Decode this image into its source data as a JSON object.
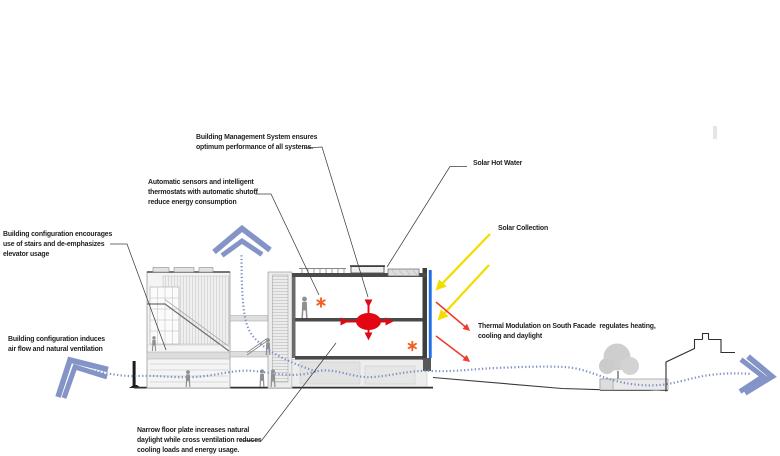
{
  "diagram_title": "Sustainable building systems section diagram",
  "annotations": {
    "bms": {
      "lines": [
        "Building Management System ensures",
        "optimum performance of all systems."
      ]
    },
    "sensors": {
      "lines": [
        "Automatic sensors and intelligent",
        "thermostats with automatic shutoff",
        "reduce energy consumption"
      ]
    },
    "stairs": {
      "lines": [
        "Building configuration encourages",
        "use of stairs and de-emphasizes",
        "elevator usage"
      ]
    },
    "airflow": {
      "lines": [
        "Building configuration induces",
        "air flow and natural ventilation"
      ]
    },
    "solar_hot_water": {
      "lines": [
        "Solar Hot Water"
      ]
    },
    "solar_collection": {
      "lines": [
        "Solar Collection"
      ]
    },
    "thermal": {
      "lines": [
        "Thermal Modulation on South Facade  regulates heating,",
        "cooling and daylight"
      ]
    },
    "narrow_floor": {
      "lines": [
        "Narrow floor plate increases natural",
        "daylight while cross ventilation reduces",
        "cooling loads and energy usage."
      ]
    }
  },
  "icons": {
    "chevron_up": "airflow-exhaust-up-arrows",
    "chevron_left": "airflow-intake-arrows",
    "chevron_right": "airflow-outlet-arrows",
    "solar_rays": "yellow-sun-ray-arrows",
    "thermal_arrows": "red-thermal-radiation-arrows",
    "cross_ventilation": "red-four-way-arrow-cross",
    "sensor_star": "orange-asterisk-marker"
  },
  "colors": {
    "facade_blue": "#1e6fe6",
    "airflow_blue": "#8494c7",
    "solar_yellow": "#f3dd00",
    "thermal_red": "#ee3d30",
    "core_red": "#e30613",
    "sensor_orange": "#f26123",
    "drawing_gray": "#8f8f8f",
    "text_black": "#1f1f1f"
  }
}
